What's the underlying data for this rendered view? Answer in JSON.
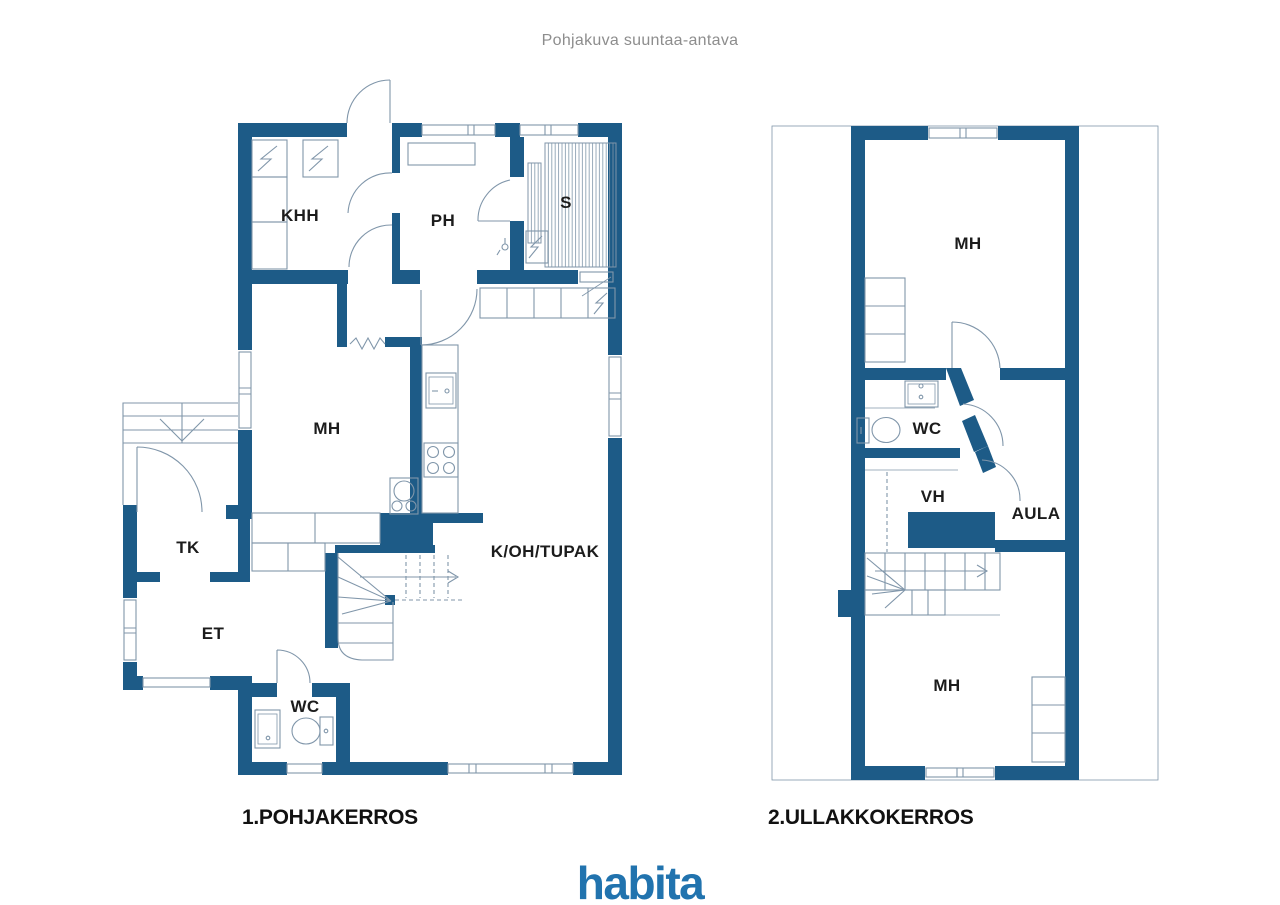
{
  "title": "Pohjakuva suuntaa-antava",
  "colors": {
    "wall": "#1d5b87",
    "line": "#8096aa",
    "text": "#1c1c1c",
    "muted": "#8d8d8d",
    "logo": "#2173ae"
  },
  "ground_floor": {
    "caption": "1.POHJAKERROS",
    "rooms": {
      "khh": "KHH",
      "ph": "PH",
      "s": "S",
      "mh": "MH",
      "tk": "TK",
      "et": "ET",
      "wc": "WC",
      "koh": "K/OH/TUPAK"
    }
  },
  "attic_floor": {
    "caption": "2.ULLAKKOKERROS",
    "rooms": {
      "mh_top": "MH",
      "wc": "WC",
      "vh": "VH",
      "aula": "AULA",
      "mh_bottom": "MH"
    }
  },
  "logo": {
    "text": "habita"
  }
}
